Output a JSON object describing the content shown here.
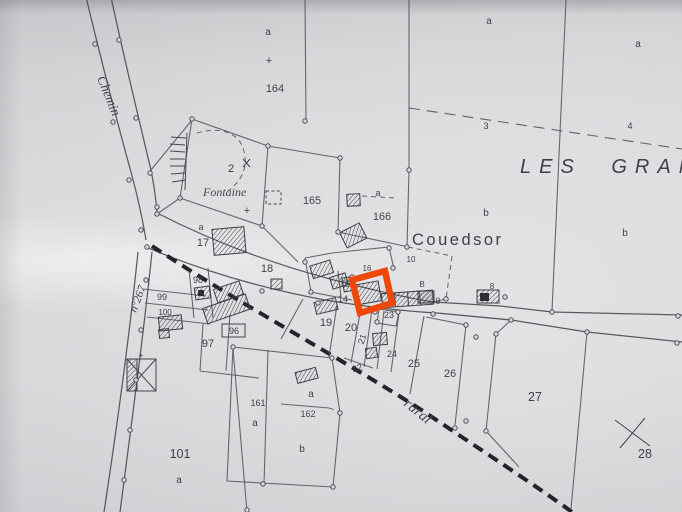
{
  "colors": {
    "highlight": "#ee4708",
    "ink": "#4d4d56",
    "ink_dark": "#26262c",
    "paper": "#d7d7d9"
  },
  "place_names": {
    "region": "LES GRAN",
    "hamlet": "Couedsor",
    "spring": "Fontaine",
    "road_top": "Chemin",
    "road_number": "n°267",
    "road_rural": "rural"
  },
  "parcel_numbers": {
    "p2": "2",
    "p3": "3",
    "p4": "4",
    "p8": "8",
    "p9": "9",
    "p10": "10",
    "p14": "14",
    "p15": "15",
    "p16": "16",
    "p17": "17",
    "p18": "18",
    "p19": "19",
    "p20": "20",
    "p21": "21",
    "p22": "22",
    "p23": "23",
    "p24": "24",
    "p25": "25",
    "p26": "26",
    "p27": "27",
    "p28": "28",
    "p96": "96",
    "p97": "97",
    "p98": "98",
    "p99": "99",
    "p100": "100",
    "p101": "101",
    "p161": "161",
    "p162": "162",
    "p164": "164",
    "p165": "165",
    "p166": "166"
  },
  "subdivision_letters": {
    "a": "a",
    "b": "b",
    "B": "B"
  },
  "symbols": {
    "plus": "+"
  }
}
